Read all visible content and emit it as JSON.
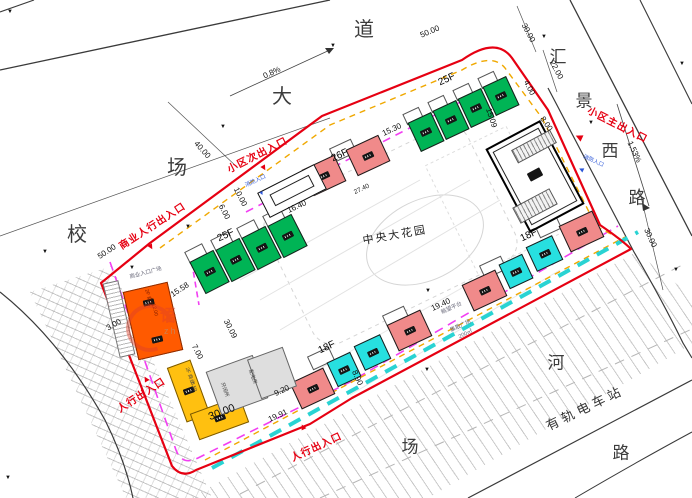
{
  "roads": {
    "top_name": "校场大道",
    "right_name": "汇景西路",
    "bottom_chars": [
      "场",
      "河",
      "路"
    ],
    "tram_station": "有轨电车站"
  },
  "central_garden": "中央大花园",
  "entrances": [
    "商业人行出入口",
    "小区次出入口",
    "小区主出入口",
    "人行出入口",
    "人行出入口",
    "消防入口",
    "消防入口"
  ],
  "floor_labels": [
    "25F",
    "25F",
    "26F",
    "18F",
    "18F"
  ],
  "slopes": [
    "0.8%",
    "1.53%"
  ],
  "dimensions": [
    "40.00",
    "50.00",
    "50.00",
    "30.00",
    "22.00",
    "4.00",
    "8.00",
    "15.09",
    "15.30",
    "16.40",
    "10.00",
    "6.00",
    "15.58",
    "30.09",
    "7.00",
    "3.00",
    "30.00",
    "9.20",
    "19.91",
    "8.90",
    "19.40",
    "27.40",
    "30.00"
  ],
  "plazas": [
    "商业入口广场",
    "眺望平台",
    "集散广场",
    "200㎡"
  ],
  "commercial_notes": [
    "2F 商业",
    "12.00",
    "2F 商业",
    "8.50",
    "开闭所",
    "配电房"
  ],
  "watermark": {
    "char": "语",
    "latin": "zh"
  },
  "colors": {
    "boundary_red": "#e60012",
    "fire_lane_cyan": "#29d3d3",
    "setback_magenta": "#f23ff2",
    "setback_yellow": "#f0a800",
    "building_green": "#00b455",
    "building_pink": "#f08a8a",
    "building_cyan": "#27e0e0",
    "building_orange": "#ff5a00",
    "building_yellow": "#ffc010"
  },
  "annotations": [
    {
      "t": "校",
      "x": 77,
      "y": 235,
      "r": 0,
      "c": "road"
    },
    {
      "t": "场",
      "x": 177,
      "y": 168,
      "r": 0,
      "c": "road"
    },
    {
      "t": "大",
      "x": 282,
      "y": 97,
      "r": 0,
      "c": "road"
    },
    {
      "t": "道",
      "x": 364,
      "y": 30,
      "r": 0,
      "c": "road"
    },
    {
      "t": "汇",
      "x": 558,
      "y": 57,
      "r": 0,
      "c": "road2"
    },
    {
      "t": "景",
      "x": 584,
      "y": 101,
      "r": 0,
      "c": "road2"
    },
    {
      "t": "西",
      "x": 610,
      "y": 151,
      "r": 0,
      "c": "road2"
    },
    {
      "t": "路",
      "x": 637,
      "y": 198,
      "r": 0,
      "c": "road2"
    },
    {
      "t": "场",
      "x": 410,
      "y": 447,
      "r": 0,
      "c": "road2"
    },
    {
      "t": "河",
      "x": 556,
      "y": 363,
      "r": 0,
      "c": "road2"
    },
    {
      "t": "路",
      "x": 621,
      "y": 453,
      "r": 0,
      "c": "road2"
    },
    {
      "t": "有轨电车站",
      "x": 585,
      "y": 408,
      "r": -26,
      "c": "station"
    },
    {
      "t": "中央大花园",
      "x": 395,
      "y": 236,
      "r": -10,
      "c": "garden"
    },
    {
      "t": "40.00",
      "x": 202,
      "y": 150,
      "r": 48,
      "c": "dim"
    },
    {
      "t": "0.8%",
      "x": 272,
      "y": 73,
      "r": -25,
      "c": "dim"
    },
    {
      "t": "50.00",
      "x": 430,
      "y": 32,
      "r": -23,
      "c": "dim"
    },
    {
      "t": "50.00",
      "x": 107,
      "y": 252,
      "r": -33,
      "c": "dim"
    },
    {
      "t": "30.00",
      "x": 528,
      "y": 33,
      "r": 62,
      "c": "dim"
    },
    {
      "t": "22.00",
      "x": 556,
      "y": 70,
      "r": 62,
      "c": "dim"
    },
    {
      "t": "4.00",
      "x": 529,
      "y": 88,
      "r": 62,
      "c": "dim"
    },
    {
      "t": "8.00",
      "x": 546,
      "y": 124,
      "r": 55,
      "c": "dim"
    },
    {
      "t": "15.09",
      "x": 491,
      "y": 118,
      "r": 72,
      "c": "dim"
    },
    {
      "t": "15.30",
      "x": 392,
      "y": 130,
      "r": -25,
      "c": "dim"
    },
    {
      "t": "16.40",
      "x": 297,
      "y": 207,
      "r": -25,
      "c": "dim"
    },
    {
      "t": "10.00",
      "x": 240,
      "y": 197,
      "r": 63,
      "c": "dim"
    },
    {
      "t": "6.00",
      "x": 224,
      "y": 212,
      "r": 63,
      "c": "dim"
    },
    {
      "t": "15.58",
      "x": 180,
      "y": 290,
      "r": -33,
      "c": "dim"
    },
    {
      "t": "30.09",
      "x": 230,
      "y": 329,
      "r": 63,
      "c": "dim"
    },
    {
      "t": "7.00",
      "x": 197,
      "y": 352,
      "r": 63,
      "c": "dim"
    },
    {
      "t": "3.00",
      "x": 114,
      "y": 325,
      "r": -30,
      "c": "dim"
    },
    {
      "t": "30.00",
      "x": 222,
      "y": 413,
      "r": -21,
      "c": "dimlg"
    },
    {
      "t": "9.20",
      "x": 282,
      "y": 391,
      "r": -25,
      "c": "dim"
    },
    {
      "t": "19.91",
      "x": 278,
      "y": 416,
      "r": -25,
      "c": "dim"
    },
    {
      "t": "8.90",
      "x": 357,
      "y": 378,
      "r": 65,
      "c": "dim"
    },
    {
      "t": "19.40",
      "x": 441,
      "y": 305,
      "r": -25,
      "c": "dim"
    },
    {
      "t": "27.40",
      "x": 362,
      "y": 190,
      "r": -25,
      "c": "dimsm"
    },
    {
      "t": "1.53%",
      "x": 634,
      "y": 152,
      "r": 65,
      "c": "dim"
    },
    {
      "t": "30.00",
      "x": 650,
      "y": 238,
      "r": 65,
      "c": "dim"
    },
    {
      "t": "25F",
      "x": 226,
      "y": 236,
      "r": -25,
      "c": "floor"
    },
    {
      "t": "25F",
      "x": 447,
      "y": 80,
      "r": -25,
      "c": "floor"
    },
    {
      "t": "26F",
      "x": 340,
      "y": 156,
      "r": -25,
      "c": "floor"
    },
    {
      "t": "18F",
      "x": 529,
      "y": 236,
      "r": -25,
      "c": "floor"
    },
    {
      "t": "18F",
      "x": 327,
      "y": 348,
      "r": -25,
      "c": "floor"
    },
    {
      "t": "商业人行出入口",
      "x": 153,
      "y": 227,
      "r": -33,
      "c": "red"
    },
    {
      "t": "小区次出入口",
      "x": 258,
      "y": 156,
      "r": -27,
      "c": "red"
    },
    {
      "t": "小区主出入口",
      "x": 617,
      "y": 126,
      "r": 27,
      "c": "red"
    },
    {
      "t": "人行出入口",
      "x": 142,
      "y": 396,
      "r": -33,
      "c": "red"
    },
    {
      "t": "人行出入口",
      "x": 317,
      "y": 448,
      "r": -25,
      "c": "red"
    },
    {
      "t": "▼",
      "x": 151,
      "y": 247,
      "r": -30,
      "c": "tri"
    },
    {
      "t": "▼",
      "x": 264,
      "y": 168,
      "r": -30,
      "c": "tri"
    },
    {
      "t": "◀",
      "x": 579,
      "y": 137,
      "r": 25,
      "c": "tri"
    },
    {
      "t": "▲",
      "x": 146,
      "y": 379,
      "r": -30,
      "c": "tri"
    },
    {
      "t": "▲",
      "x": 303,
      "y": 427,
      "r": -25,
      "c": "tri"
    },
    {
      "t": "消防入口",
      "x": 256,
      "y": 182,
      "r": -25,
      "c": "blue"
    },
    {
      "t": "▼",
      "x": 262,
      "y": 194,
      "r": -25,
      "c": "btri"
    },
    {
      "t": "消防入口",
      "x": 593,
      "y": 162,
      "r": 25,
      "c": "blue"
    },
    {
      "t": "◀",
      "x": 581,
      "y": 170,
      "r": 25,
      "c": "btri"
    },
    {
      "t": "商业入口广场",
      "x": 146,
      "y": 274,
      "r": -15,
      "c": "tiny"
    },
    {
      "t": "眺望平台",
      "x": 452,
      "y": 309,
      "r": -25,
      "c": "tiny"
    },
    {
      "t": "集散广场",
      "x": 461,
      "y": 327,
      "r": -25,
      "c": "tiny"
    },
    {
      "t": "200㎡",
      "x": 466,
      "y": 335,
      "r": -25,
      "c": "tiny"
    },
    {
      "t": "2F 商业",
      "x": 148,
      "y": 298,
      "r": 75,
      "c": "tinyo"
    },
    {
      "t": "12.00",
      "x": 154,
      "y": 310,
      "r": 75,
      "c": "tinyo"
    },
    {
      "t": "2F 商业",
      "x": 189,
      "y": 376,
      "r": 70,
      "c": "tinyd"
    },
    {
      "t": "8.50",
      "x": 193,
      "y": 387,
      "r": 70,
      "c": "tinyd"
    },
    {
      "t": "开闭所",
      "x": 224,
      "y": 390,
      "r": 70,
      "c": "tinyd"
    },
    {
      "t": "配电房",
      "x": 252,
      "y": 377,
      "r": 70,
      "c": "tinyd"
    }
  ],
  "elevation_markers": [
    [
      10,
      12
    ],
    [
      333,
      46
    ],
    [
      223,
      127
    ],
    [
      188,
      227
    ],
    [
      544,
      37
    ],
    [
      591,
      123
    ],
    [
      45,
      252
    ],
    [
      132,
      268
    ],
    [
      427,
      370
    ],
    [
      428,
      291
    ],
    [
      676,
      270
    ],
    [
      8,
      478
    ],
    [
      682,
      64
    ]
  ],
  "buildings": [
    {
      "n": "tower-25f-a-unit",
      "x": 196,
      "y": 254,
      "w": 27,
      "h": 36,
      "r": -27,
      "c": "green",
      "tag": 1
    },
    {
      "n": "tower-25f-a-unit",
      "x": 222,
      "y": 242,
      "w": 27,
      "h": 36,
      "r": -27,
      "c": "green",
      "tag": 1
    },
    {
      "n": "tower-25f-a-unit",
      "x": 248,
      "y": 230,
      "w": 27,
      "h": 36,
      "r": -27,
      "c": "green",
      "tag": 1
    },
    {
      "n": "tower-25f-a-unit",
      "x": 274,
      "y": 218,
      "w": 27,
      "h": 36,
      "r": -27,
      "c": "green",
      "tag": 1
    },
    {
      "n": "balcony-outline",
      "x": 186,
      "y": 247,
      "w": 20,
      "h": 13,
      "r": -27,
      "c": "bal"
    },
    {
      "n": "balcony-outline",
      "x": 212,
      "y": 235,
      "w": 20,
      "h": 13,
      "r": -27,
      "c": "bal"
    },
    {
      "n": "balcony-outline",
      "x": 238,
      "y": 223,
      "w": 20,
      "h": 13,
      "r": -27,
      "c": "bal"
    },
    {
      "n": "balcony-outline",
      "x": 264,
      "y": 211,
      "w": 20,
      "h": 13,
      "r": -27,
      "c": "bal"
    },
    {
      "n": "tower-25f-b-unit",
      "x": 413,
      "y": 116,
      "w": 26,
      "h": 32,
      "r": -25,
      "c": "green",
      "tag": 1
    },
    {
      "n": "tower-25f-b-unit",
      "x": 438,
      "y": 104,
      "w": 26,
      "h": 32,
      "r": -25,
      "c": "green",
      "tag": 1
    },
    {
      "n": "tower-25f-b-unit",
      "x": 463,
      "y": 92,
      "w": 26,
      "h": 32,
      "r": -25,
      "c": "green",
      "tag": 1
    },
    {
      "n": "tower-25f-b-unit",
      "x": 488,
      "y": 80,
      "w": 26,
      "h": 32,
      "r": -25,
      "c": "green",
      "tag": 1
    },
    {
      "n": "balcony-outline",
      "x": 404,
      "y": 110,
      "w": 18,
      "h": 12,
      "r": -25,
      "c": "bal"
    },
    {
      "n": "balcony-outline",
      "x": 429,
      "y": 98,
      "w": 18,
      "h": 12,
      "r": -25,
      "c": "bal"
    },
    {
      "n": "balcony-outline",
      "x": 454,
      "y": 86,
      "w": 18,
      "h": 12,
      "r": -25,
      "c": "bal"
    },
    {
      "n": "balcony-outline",
      "x": 479,
      "y": 74,
      "w": 18,
      "h": 12,
      "r": -25,
      "c": "bal"
    },
    {
      "n": "tower-26f-unit",
      "x": 306,
      "y": 161,
      "w": 36,
      "h": 29,
      "r": -25,
      "c": "pink",
      "tag": 1
    },
    {
      "n": "tower-26f-unit",
      "x": 350,
      "y": 141,
      "w": 36,
      "h": 29,
      "r": -25,
      "c": "pink",
      "tag": 1
    },
    {
      "n": "balcony-outline",
      "x": 331,
      "y": 143,
      "w": 24,
      "h": 15,
      "r": -25,
      "c": "bal"
    },
    {
      "n": "tower-18f-east-unit",
      "x": 563,
      "y": 217,
      "w": 37,
      "h": 29,
      "r": -25,
      "c": "pink",
      "tag": 1
    },
    {
      "n": "tower-18f-east-unit",
      "x": 530,
      "y": 240,
      "w": 29,
      "h": 27,
      "r": -25,
      "c": "cyan",
      "tag": 1
    },
    {
      "n": "tower-18f-east-unit",
      "x": 503,
      "y": 258,
      "w": 26,
      "h": 27,
      "r": -25,
      "c": "cyan",
      "tag": 1
    },
    {
      "n": "tower-18f-east-unit",
      "x": 466,
      "y": 276,
      "w": 37,
      "h": 29,
      "r": -25,
      "c": "pink",
      "tag": 1
    },
    {
      "n": "balcony-outline",
      "x": 536,
      "y": 219,
      "w": 24,
      "h": 15,
      "r": -25,
      "c": "bal"
    },
    {
      "n": "balcony-outline",
      "x": 481,
      "y": 260,
      "w": 24,
      "h": 15,
      "r": -25,
      "c": "bal"
    },
    {
      "n": "tower-18f-south-unit",
      "x": 391,
      "y": 316,
      "w": 37,
      "h": 29,
      "r": -25,
      "c": "pink",
      "tag": 1
    },
    {
      "n": "tower-18f-south-unit",
      "x": 358,
      "y": 339,
      "w": 29,
      "h": 27,
      "r": -25,
      "c": "cyan",
      "tag": 1
    },
    {
      "n": "tower-18f-south-unit",
      "x": 331,
      "y": 356,
      "w": 26,
      "h": 27,
      "r": -25,
      "c": "cyan",
      "tag": 1
    },
    {
      "n": "tower-18f-south-unit",
      "x": 294,
      "y": 374,
      "w": 37,
      "h": 29,
      "r": -25,
      "c": "pink",
      "tag": 1
    },
    {
      "n": "balcony-outline",
      "x": 384,
      "y": 310,
      "w": 24,
      "h": 15,
      "r": -25,
      "c": "bal"
    },
    {
      "n": "balcony-outline",
      "x": 309,
      "y": 351,
      "w": 24,
      "h": 15,
      "r": -25,
      "c": "bal"
    },
    {
      "n": "commercial-block-orange",
      "x": 130,
      "y": 286,
      "w": 46,
      "h": 70,
      "r": -13,
      "c": "orange",
      "tag": 2
    },
    {
      "n": "parking-strip",
      "x": 111,
      "y": 281,
      "w": 16,
      "h": 76,
      "r": -13,
      "c": "stripe"
    },
    {
      "n": "commercial-block-yellow",
      "x": 176,
      "y": 362,
      "w": 25,
      "h": 58,
      "r": -20,
      "c": "yellow",
      "tag": 1
    },
    {
      "n": "commercial-block-yellow",
      "x": 193,
      "y": 404,
      "w": 53,
      "h": 28,
      "r": -20,
      "c": "yellow",
      "tag": 1
    },
    {
      "n": "utility-block",
      "x": 212,
      "y": 362,
      "w": 50,
      "h": 46,
      "r": -20,
      "c": "gray"
    },
    {
      "n": "utility-block",
      "x": 253,
      "y": 352,
      "w": 38,
      "h": 42,
      "r": -20,
      "c": "gray"
    },
    {
      "n": "gatehouse",
      "x": 260,
      "y": 177,
      "w": 64,
      "h": 28,
      "r": -27,
      "c": "white2"
    },
    {
      "n": "gatehouse-inner",
      "x": 270,
      "y": 184,
      "w": 44,
      "h": 13,
      "r": -27,
      "c": "white3"
    },
    {
      "n": "clubhouse",
      "x": 504,
      "y": 129,
      "w": 62,
      "h": 95,
      "r": -28,
      "c": "clubA"
    },
    {
      "n": "clubhouse-inner",
      "x": 509,
      "y": 135,
      "w": 52,
      "h": 83,
      "r": -28,
      "c": "clubB"
    },
    {
      "n": "clubhouse-stairs",
      "x": 512,
      "y": 139,
      "w": 44,
      "h": 15,
      "r": -28,
      "c": "hatchband"
    },
    {
      "n": "clubhouse-stairs",
      "x": 514,
      "y": 197,
      "w": 42,
      "h": 18,
      "r": -28,
      "c": "hatchband"
    },
    {
      "n": "clubhouse-core",
      "x": 528,
      "y": 170,
      "w": 14,
      "h": 9,
      "r": -28,
      "c": "dark"
    }
  ]
}
